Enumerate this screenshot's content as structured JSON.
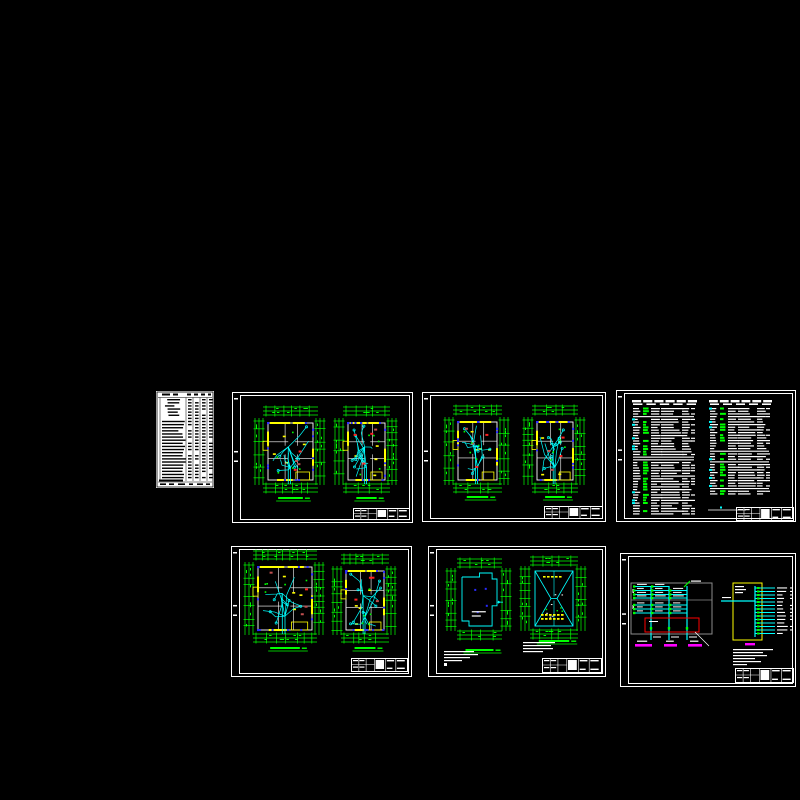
{
  "app": {
    "description": "CAD drawing set preview - seven engineering sheets (electrical plans, schedules, system diagram) on black canvas",
    "visible_text_note": "all lettering below legibility threshold; rendered as glyph bars"
  },
  "palette": {
    "background": "#000000",
    "frame": "#ffffff",
    "paper": "#ffffff",
    "ink": "#000000",
    "dimension_green": "#00ff00",
    "wire_cyan": "#00ffff",
    "wall_yellow": "#ffff00",
    "socket_blue": "#2a2aff",
    "equip_red": "#ff2222",
    "equip_brown": "#c05050",
    "label_magenta": "#ff00ff",
    "panel_gray": "#8c8c8c",
    "box_yellow": "#ffff00",
    "box_red": "#ff0000"
  },
  "sheets": [
    {
      "id": "drawing-list",
      "type": "paper_table",
      "x": 156,
      "y": 391,
      "w": 58,
      "h": 97,
      "seed": 11,
      "rows": 26,
      "header_h": 7,
      "col_lines": [
        4,
        30,
        37,
        44,
        51
      ],
      "footer_h": 7
    },
    {
      "id": "plan-pair-a",
      "type": "plan_pair",
      "x": 232,
      "y": 392,
      "w": 181,
      "h": 131,
      "seed": 21,
      "plans": [
        {
          "x": 36,
          "y": 31,
          "w": 45,
          "h": 57
        },
        {
          "x": 116,
          "y": 31,
          "w": 37,
          "h": 57
        }
      ],
      "title_y": 105,
      "titleblock": {
        "x": 121,
        "y": 116,
        "w": 56,
        "h": 11
      }
    },
    {
      "id": "plan-pair-b",
      "type": "plan_pair",
      "x": 422,
      "y": 392,
      "w": 184,
      "h": 130,
      "seed": 31,
      "plans": [
        {
          "x": 36,
          "y": 30,
          "w": 39,
          "h": 58
        },
        {
          "x": 115,
          "y": 30,
          "w": 36,
          "h": 58
        }
      ],
      "title_y": 104,
      "titleblock": {
        "x": 122,
        "y": 114,
        "w": 58,
        "h": 12
      }
    },
    {
      "id": "legend-tables",
      "type": "legend_tables",
      "x": 616,
      "y": 390,
      "w": 180,
      "h": 132,
      "seed": 41,
      "tables": [
        {
          "x": 15,
          "y": 10,
          "w": 67,
          "h": 116,
          "rows": 40
        },
        {
          "x": 92,
          "y": 10,
          "w": 65,
          "h": 96,
          "rows": 33
        }
      ],
      "titleblock": {
        "x": 120,
        "y": 117,
        "w": 57,
        "h": 13
      }
    },
    {
      "id": "plan-pair-c",
      "type": "plan_pair",
      "x": 231,
      "y": 546,
      "w": 181,
      "h": 131,
      "seed": 51,
      "plans": [
        {
          "x": 27,
          "y": 21,
          "w": 54,
          "h": 63
        },
        {
          "x": 115,
          "y": 25,
          "w": 38,
          "h": 59
        }
      ],
      "title_y": 101,
      "titleblock": {
        "x": 120,
        "y": 112,
        "w": 56,
        "h": 13
      }
    },
    {
      "id": "plan-roof",
      "type": "plan_roof",
      "x": 428,
      "y": 546,
      "w": 178,
      "h": 131,
      "seed": 61,
      "outline": {
        "x": 34,
        "y": 27,
        "w": 35,
        "h": 53
      },
      "roof": {
        "x": 107,
        "y": 25,
        "w": 38,
        "h": 55
      },
      "titleblock": {
        "x": 114,
        "y": 112,
        "w": 59,
        "h": 14
      }
    },
    {
      "id": "system-diagram",
      "type": "system_diagram",
      "x": 620,
      "y": 553,
      "w": 176,
      "h": 134,
      "seed": 71,
      "gray_box": {
        "x": 11,
        "y": 30,
        "w": 81,
        "h": 51,
        "divider_y": 47
      },
      "red_box": {
        "x": 25,
        "y": 65,
        "w": 54,
        "h": 14
      },
      "trunks": [
        31,
        49,
        67
      ],
      "magenta_labels": [
        {
          "x": 15,
          "w": 17
        },
        {
          "x": 44,
          "w": 13
        },
        {
          "x": 68,
          "w": 14
        }
      ],
      "magenta_y": 91,
      "yellow_box": {
        "x": 113,
        "y": 30,
        "w": 29,
        "h": 57,
        "bus_x": 135,
        "circuits": 14,
        "line_end": 155,
        "text_x": 157
      },
      "feeder": {
        "x1": 101,
        "y": 48
      },
      "magenta_small": {
        "x": 125,
        "y": 90,
        "w": 10
      },
      "titleblock": {
        "x": 115,
        "y": 115,
        "w": 58,
        "h": 14
      }
    }
  ]
}
